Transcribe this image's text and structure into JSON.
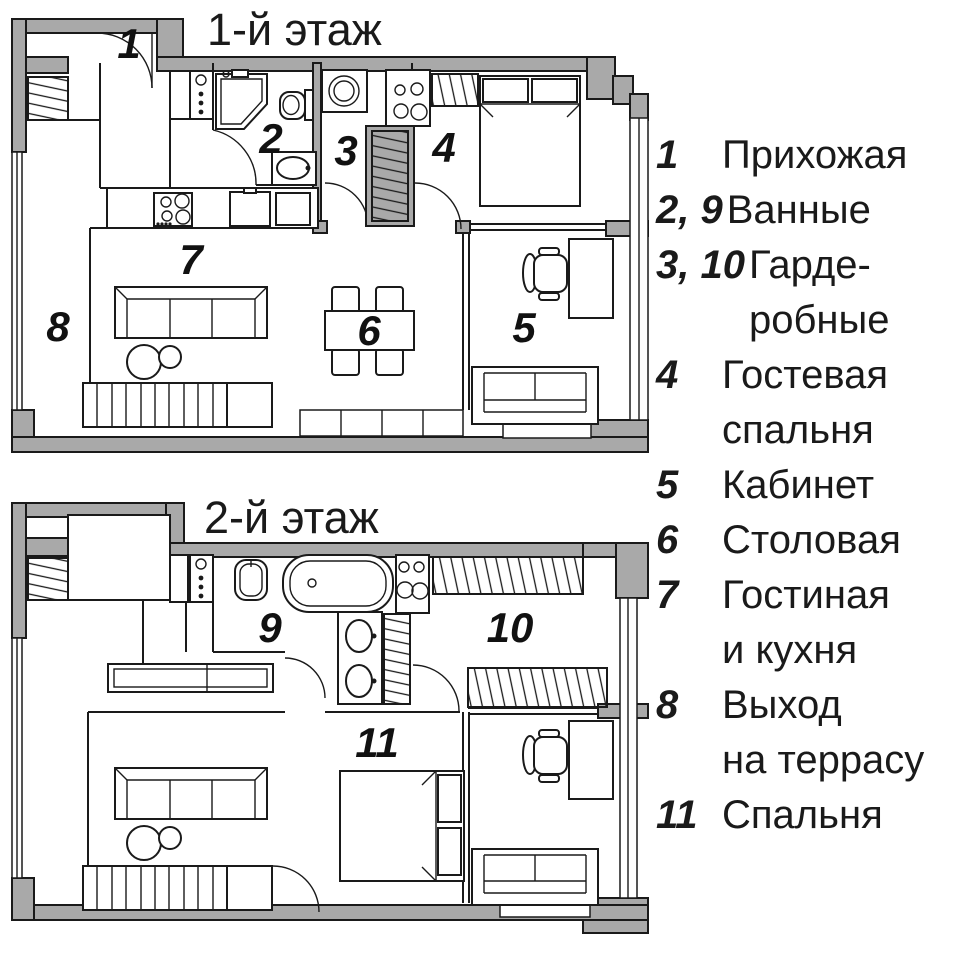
{
  "floor1": {
    "title": "1-й этаж",
    "labels": [
      "1",
      "2",
      "3",
      "4",
      "5",
      "6",
      "7",
      "8"
    ]
  },
  "floor2": {
    "title": "2-й этаж",
    "labels": [
      "9",
      "10",
      "11"
    ]
  },
  "legend": {
    "items": [
      {
        "num": "1",
        "lines": [
          "Прихожая",
          ""
        ]
      },
      {
        "num": "2, 9",
        "lines": [
          "Ванные",
          ""
        ]
      },
      {
        "num": "3, 10",
        "lines": [
          "Гарде-",
          "робные"
        ]
      },
      {
        "num": "4",
        "lines": [
          "Гостевая",
          "спальня"
        ]
      },
      {
        "num": "5",
        "lines": [
          "Кабинет",
          ""
        ]
      },
      {
        "num": "6",
        "lines": [
          "Столовая",
          ""
        ]
      },
      {
        "num": "7",
        "lines": [
          "Гостиная",
          "и кухня"
        ]
      },
      {
        "num": "8",
        "lines": [
          "Выход",
          "на террасу"
        ]
      },
      {
        "num": "11",
        "lines": [
          "Спальня",
          ""
        ]
      }
    ]
  },
  "colors": {
    "wall": "#a9a9a9",
    "line": "#1a1a1a",
    "paper": "#ffffff"
  }
}
